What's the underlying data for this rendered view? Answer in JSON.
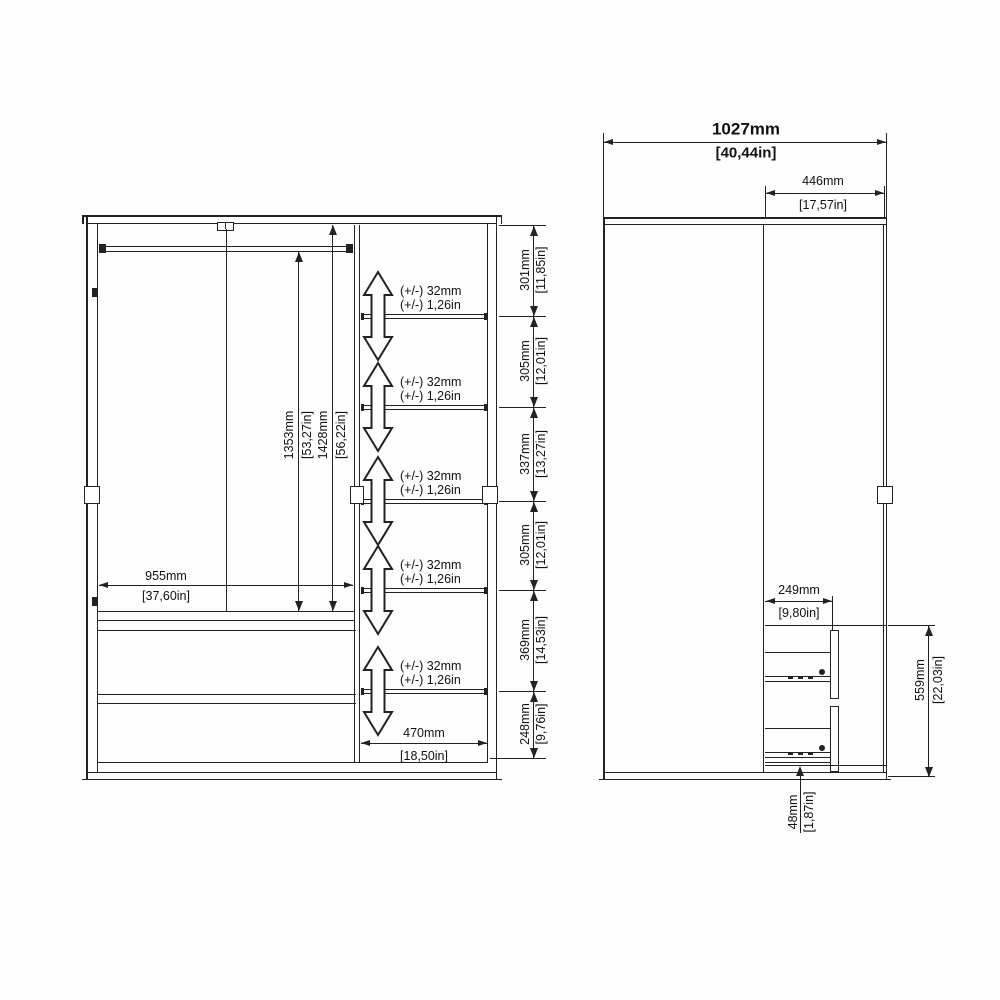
{
  "front_view": {
    "interior_width": {
      "mm": "955mm",
      "in": "[37,60in]"
    },
    "rail_height": {
      "mm": "1353mm",
      "in": "[53,27in]"
    },
    "interior_height": {
      "mm": "1428mm",
      "in": "[56,22in]"
    },
    "shelf_section_width": {
      "mm": "470mm",
      "in": "[18,50in]"
    },
    "shelf_spacings": [
      {
        "mm": "301mm",
        "in": "[11,85in]"
      },
      {
        "mm": "305mm",
        "in": "[12,01in]"
      },
      {
        "mm": "337mm",
        "in": "[13,27in]"
      },
      {
        "mm": "305mm",
        "in": "[12,01in]"
      },
      {
        "mm": "369mm",
        "in": "[14,53in]"
      },
      {
        "mm": "248mm",
        "in": "[9,76in]"
      }
    ],
    "shelf_adjustability": {
      "mm": "(+/-) 32mm",
      "in": "(+/-) 1,26in"
    }
  },
  "side_view": {
    "overall_width": {
      "mm": "1027mm",
      "in": "[40,44in]"
    },
    "door_panel_width": {
      "mm": "446mm",
      "in": "[17,57in]"
    },
    "drawer_depth": {
      "mm": "249mm",
      "in": "[9,80in]"
    },
    "drawer_unit_height": {
      "mm": "559mm",
      "in": "[22,03in]"
    },
    "plinth_height": {
      "mm": "48mm",
      "in": "[1,87in]"
    }
  }
}
